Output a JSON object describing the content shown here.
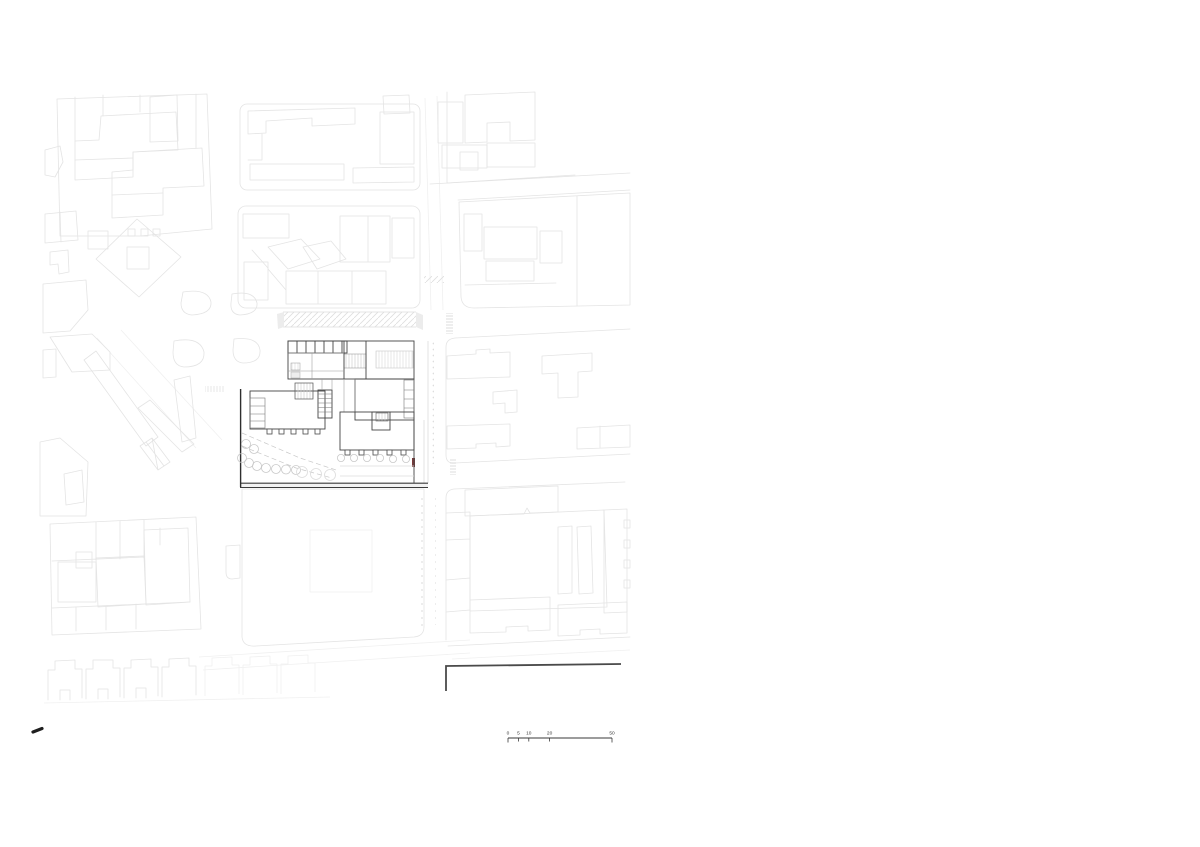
{
  "drawing": {
    "type_label": "architectural site plan",
    "colors": {
      "background": "#ffffff",
      "fabric_line": "#e4e4e4",
      "fabric_faint": "#f0f0f0",
      "street_furniture": "#c9c9c9",
      "building_line": "#454545",
      "boundary_dark": "#2e2e2e",
      "accent_mark": "#7a3b3b",
      "scale_text": "#3a3a3a"
    }
  },
  "scale_bar": {
    "labels": [
      "0",
      "5",
      "10",
      "20",
      "50"
    ],
    "unit_values": [
      0,
      5,
      10,
      20,
      50
    ],
    "max_value": 50,
    "origin_x": 508,
    "baseline_y": 738,
    "length_px": 104
  },
  "marks": {
    "north_mark": "pen-dash"
  }
}
